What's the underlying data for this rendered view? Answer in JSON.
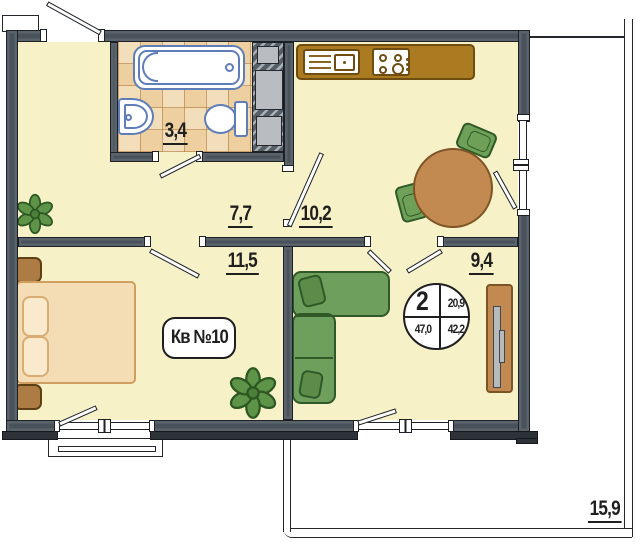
{
  "document": {
    "kind": "apartment floor plan"
  },
  "rooms": {
    "bathroom": {
      "area": "3,4"
    },
    "hallway": {
      "area": "7,7"
    },
    "kitchen": {
      "area": "10,2"
    },
    "bedroom": {
      "area": "11,5"
    },
    "living": {
      "area": "9,4"
    },
    "terrace": {
      "area": "15,9"
    }
  },
  "apartment": {
    "label": "Кв №10"
  },
  "stamp": {
    "top_left": "2",
    "top_right": "20,9",
    "bottom_left": "47,0",
    "bottom_right": "42,2"
  },
  "colors": {
    "wall": "#49525a",
    "floor": "#f6f1c6",
    "tile_light": "#f3debc",
    "tile_dark": "#eecf9f",
    "sanitary_outline": "#5f7db8",
    "counter": "#ab7b21",
    "wood": "#c28a50",
    "sofa_green": "#6f9f5c",
    "bed_tan": "#f4dcb4",
    "ink": "#1f1f1f"
  }
}
